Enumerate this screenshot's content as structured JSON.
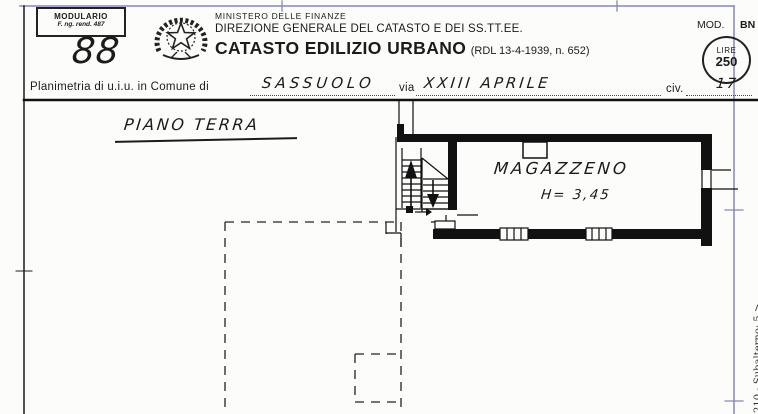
{
  "header": {
    "modulario": {
      "line1": "MODULARIO",
      "line2": "F. ng. rend. 487"
    },
    "protocol_number": "88",
    "ministry_line1": "MINISTERO DELLE FINANZE",
    "ministry_line2": "DIREZIONE GENERALE DEL CATASTO E DEI SS.TT.EE.",
    "title": "CATASTO EDILIZIO URBANO",
    "title_ref": "(RDL 13-4-1939, n. 652)",
    "mod_label": "MOD.",
    "mod_value": "BN",
    "stamp_currency": "LIRE",
    "stamp_value": "250"
  },
  "subject_line": {
    "label_comune": "Planimetria di u.i.u. in Comune di",
    "comune_value": "SASSUOLO",
    "label_via": "via",
    "via_value": "XXIII APRILE",
    "label_civ": "civ.",
    "civ_value": "17"
  },
  "plan": {
    "floor_label": "PIANO TERRA",
    "room_label": "MAGAZZENO",
    "room_height_label": "H= 3,45"
  },
  "margin_note": "210 - Subalterno: 5 >",
  "icons": {
    "emblem": "italian-republic-emblem",
    "stamp": "lire-250-stamp"
  },
  "colors": {
    "ink": "#1b1b1b",
    "frame_blue": "#8585c4"
  }
}
